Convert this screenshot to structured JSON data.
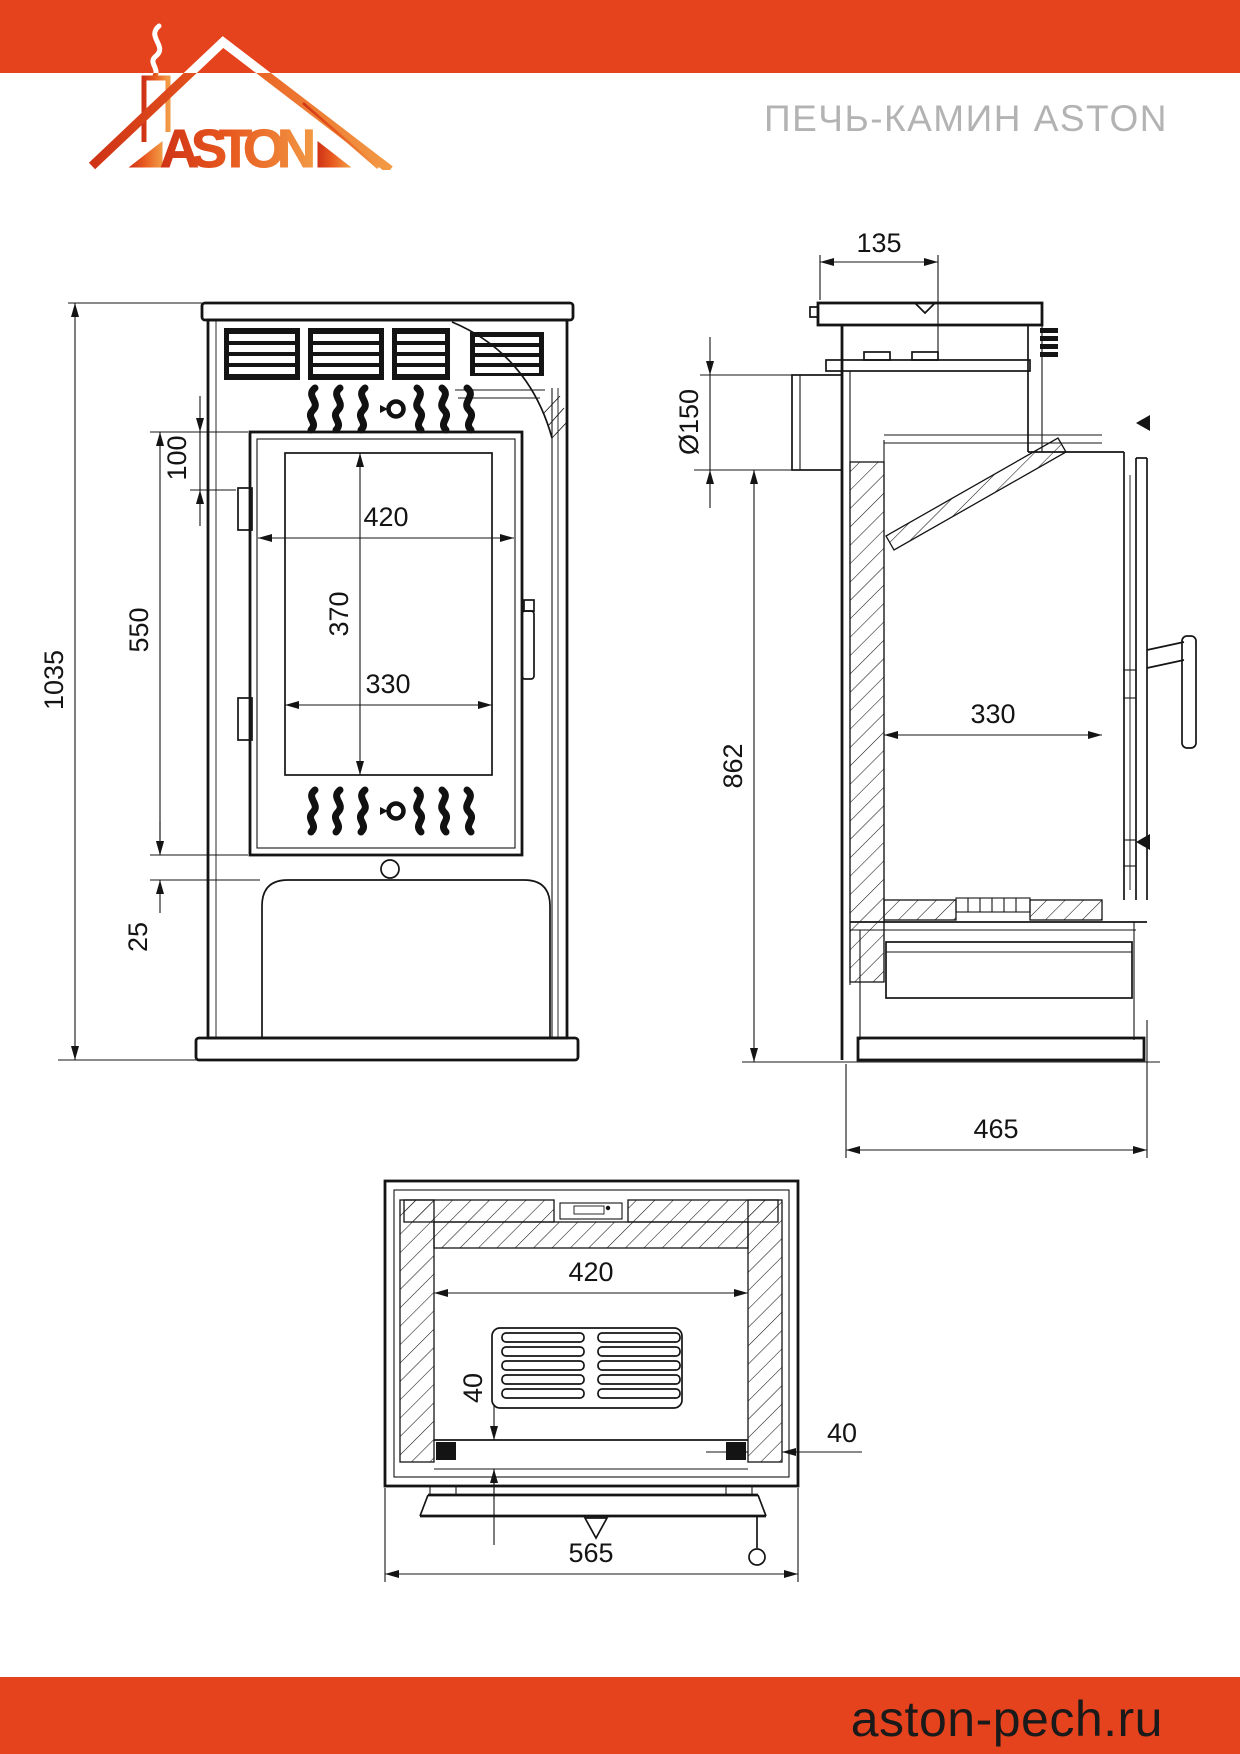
{
  "header": {
    "band_color": "#e5431d",
    "logo_text": "ASTON",
    "title": "ПЕЧЬ-КАМИН ASTON"
  },
  "footer": {
    "band_color": "#e5431d",
    "site": "aston-pech.ru"
  },
  "drawing": {
    "front_view": {
      "dim_overall_height": "1035",
      "dim_door_top_offset": "100",
      "dim_door_height": "550",
      "dim_door_to_drawer_gap": "25",
      "dim_opening_width": "420",
      "dim_glass_height": "370",
      "dim_glass_width": "330"
    },
    "side_view": {
      "dim_flue_offset": "135",
      "dim_flue_diameter": "Ø150",
      "dim_flue_height": "862",
      "dim_firebox_depth": "330",
      "dim_overall_depth": "465"
    },
    "top_view": {
      "dim_firebox_width": "420",
      "dim_front_gap": "40",
      "dim_side_gap": "40",
      "dim_overall_width": "565"
    }
  }
}
